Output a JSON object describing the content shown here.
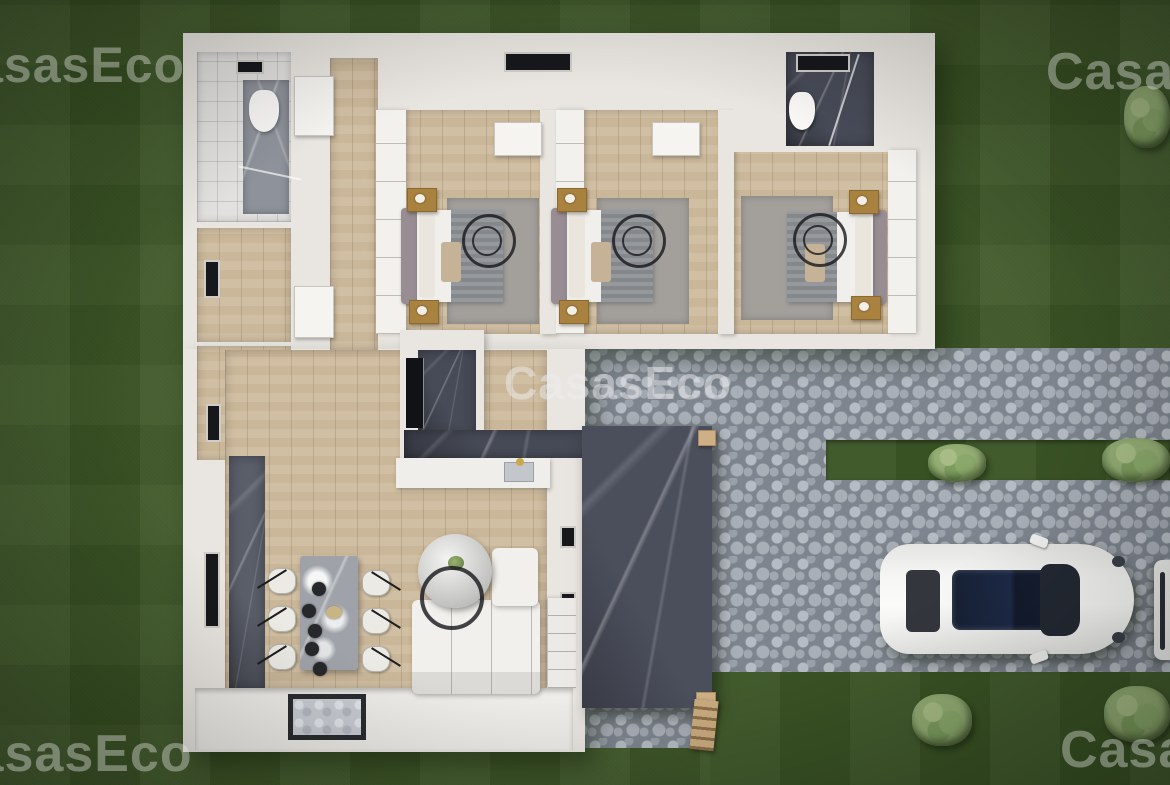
{
  "watermarks": {
    "brand": "CasasEco",
    "top_left": "CasasEco",
    "top_right": "CasasEco",
    "center": "CasasEco",
    "bottom_left": "CasasEco",
    "bottom_right": "CasasEco"
  },
  "palette": {
    "grass": "#3d5726",
    "cobblestone": "#7e858e",
    "wall_white": "#e9e6e1",
    "wood_floor": "#cfbc9e",
    "dark_marble": "#474b57",
    "grey_marble": "#8e929a",
    "bed_blanket": "#8d9094",
    "nightstand_gold": "#a9823f",
    "car_body": "#f2f2f0",
    "bush_green": "#93ad74",
    "watermark": "rgba(228,230,224,0.40)"
  },
  "scene": {
    "kind": "aerial-3d-floor-plan-render",
    "objects": [
      "house",
      "three-bedrooms",
      "two-bathrooms",
      "living-room",
      "dining-table",
      "kitchen-counters",
      "sofa",
      "coffee-table",
      "pergola-terrace",
      "cobblestone-driveway",
      "white-car",
      "garden-bushes",
      "doormat"
    ]
  }
}
